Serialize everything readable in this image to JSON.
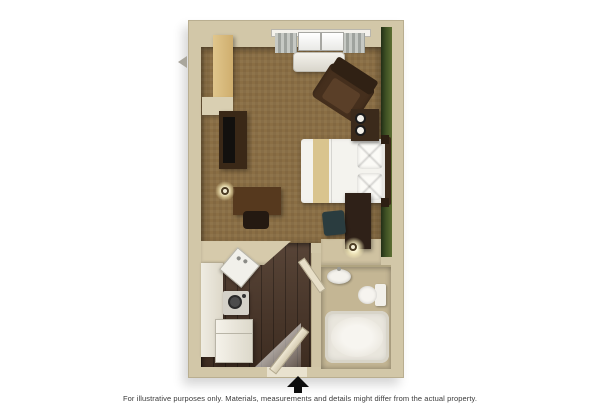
{
  "page": {
    "background": "#ffffff",
    "type": "studio-suite-floor-plan-rendering"
  },
  "footer": {
    "disclaimer": "For illustrative purposes only.  Materials, measurements and details might differ from the actual property.",
    "entrance_marker": "black-up-arrow"
  },
  "palette": {
    "wall": "#d2c7a8",
    "accent_wall_green": "#3f5124",
    "carpet_brown": "#8a6e44",
    "wood_floor": "#4b3628",
    "bathroom_floor": "#c4b694",
    "counter_white": "#efece2",
    "closet_wood": "#d9bb7d",
    "furniture_dark_wood": "#3a2817",
    "bedding_white": "#f4f3ee",
    "bed_accent_stripe": "#d9c48e",
    "teal_accent": "#2a3c3f",
    "lamp_glow": "#fff9d8"
  },
  "floorplan": {
    "rooms": [
      {
        "name": "bedroom-living-area",
        "floor": "carpet"
      },
      {
        "name": "kitchen-entry",
        "floor": "dark-wood"
      },
      {
        "name": "bathroom",
        "floor": "tile"
      }
    ],
    "furniture": [
      "closet",
      "wall-shelf",
      "window-with-curtains",
      "ac-unit",
      "armchair",
      "tv-stand",
      "television",
      "desk",
      "desk-chair",
      "desk-lamp",
      "bed",
      "pillows",
      "nightstand",
      "lamp-rings",
      "chest-of-drawers",
      "teal-side-chair",
      "floor-lamp",
      "kitchen-counter",
      "kitchen-sink",
      "cooktop",
      "refrigerator",
      "entry-door",
      "bathroom-door",
      "bathroom-sink",
      "toilet",
      "bathtub"
    ]
  }
}
